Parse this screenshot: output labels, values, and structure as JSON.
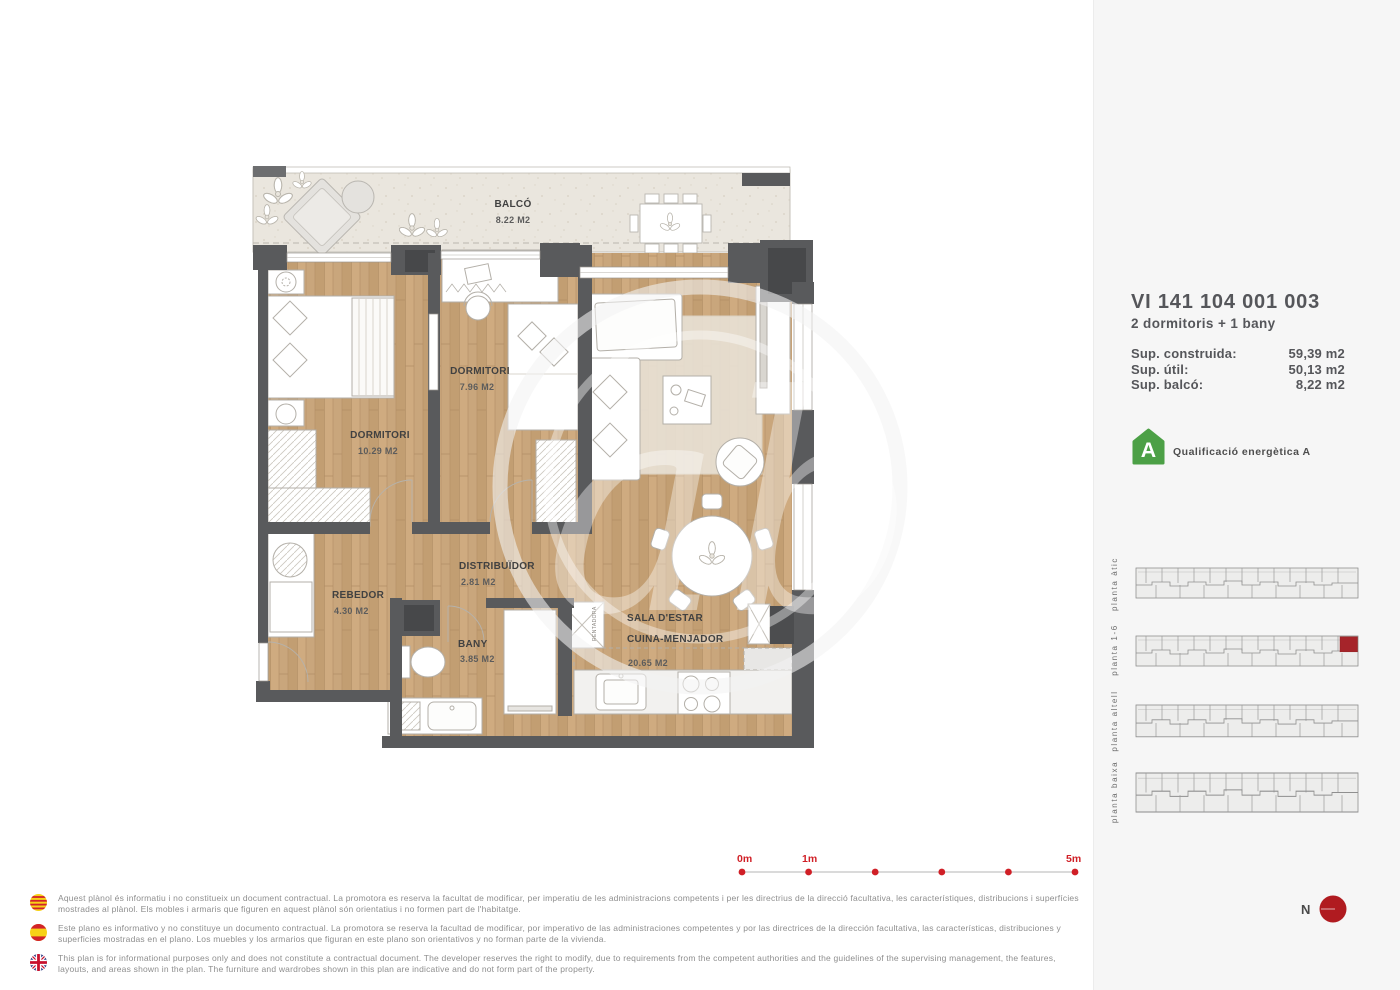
{
  "property": {
    "code": "VI 141 104 001 003",
    "layout": "2 dormitoris + 1 bany",
    "surfaces": [
      {
        "label": "Sup. construida:",
        "value": "59,39 m2"
      },
      {
        "label": "Sup. útil:",
        "value": "50,13 m2"
      },
      {
        "label": "Sup. balcó:",
        "value": "8,22 m2"
      }
    ],
    "energy": {
      "letter": "A",
      "label": "Qualificació energètica A",
      "color": "#4ca046"
    }
  },
  "rooms": {
    "balco": {
      "name": "BALCÓ",
      "area": "8.22 M2"
    },
    "dorm1": {
      "name": "DORMITORI",
      "area": "10.29 M2"
    },
    "dorm2": {
      "name": "DORMITORI",
      "area": "7.96 M2"
    },
    "rebedor": {
      "name": "REBEDOR",
      "area": "4.30 M2"
    },
    "distribuidor": {
      "name": "DISTRIBUÏDOR",
      "area": "2.81 M2"
    },
    "bany": {
      "name": "BANY",
      "area": "3.85 M2"
    },
    "sala": {
      "line1": "SALA D'ESTAR",
      "line2": "CUINA-MENJADOR",
      "area": "20.65 M2"
    }
  },
  "appliances": {
    "washer": "RENTADORA"
  },
  "levels": [
    {
      "label": "planta àtic",
      "highlight": false
    },
    {
      "label": "planta 1-6",
      "highlight": true
    },
    {
      "label": "planta altell",
      "highlight": false
    },
    {
      "label": "planta baixa",
      "highlight": false
    }
  ],
  "scale": {
    "t0": "0m",
    "t1": "1m",
    "t5": "5m"
  },
  "north": {
    "label": "N"
  },
  "disclaimers": [
    {
      "flag": "catalonia-flag",
      "text": "Aquest plànol és informatiu i no constitueix un document contractual. La promotora es reserva la facultat de modificar, per imperatiu de les administracions competents i per les directrius de la direcció facultativa, les característiques, distribucions i superfícies mostrades al plànol. Els mobles i armaris que figuren en aquest plànol són orientatius i no formen part de l'habitatge."
    },
    {
      "flag": "spain-flag",
      "text": "Este plano es informativo y no constituye un documento contractual. La promotora se reserva la facultad de modificar, por imperativo de las administraciones competentes y por las directrices de la dirección facultativa, las características, distribuciones y superficies mostradas en el plano. Los muebles y los armarios que figuran en este plano son orientativos y no forman parte de la vivienda."
    },
    {
      "flag": "uk-flag",
      "text": "This plan is for informational purposes only and does not constitute a contractual document. The developer reserves the right to modify, due to requirements from the competent authorities and the guidelines of the supervising management, the features, layouts, and areas shown in the plan. The furniture and wardrobes shown in this plan are indicative and do not form part of the property."
    }
  ],
  "colors": {
    "accent_red": "#d01f26",
    "unit_highlight_red": "#a6242a",
    "energy_green": "#4ca046",
    "wall_gray": "#595a5c",
    "wood": "#c9a67c",
    "balcony_floor": "#eae6de",
    "sidebar_bg": "#f6f6f6"
  }
}
